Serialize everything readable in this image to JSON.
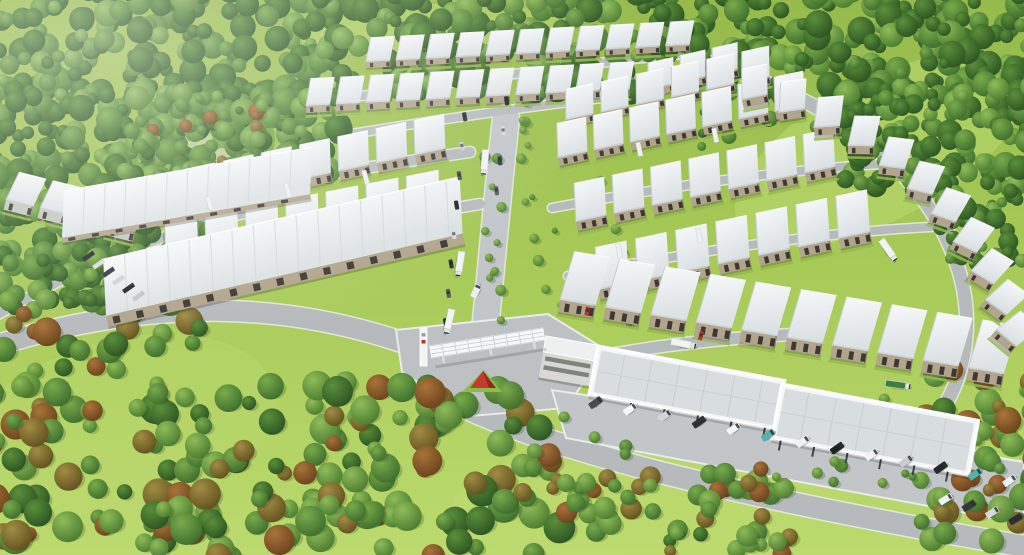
{
  "scene": {
    "width": 1024,
    "height": 555,
    "alt_text": "Aerial 3D rendering of a logistics industrial park with rows of white-roofed warehouses surrounded by forest, an entrance gate with truss gantry, office building and long parking canopy with vans"
  },
  "palette": {
    "grass_top": "#96ba4b",
    "grass_mid": "#a6c957",
    "grass_bottom": "#bcda6e",
    "meadow": "#bedb72",
    "road": "#b6babd",
    "road_light": "#c2c6c9",
    "curb": "#e9ebea",
    "roof_hi": "#f7f9fa",
    "roof_lo": "#dce1e4",
    "fascia": "#ccd3d7",
    "wall_tan": "#b2a48d",
    "wall_dark": "#94886f",
    "wall_gray": "#c6c6c0",
    "door": "#3d3833",
    "canopy_panel": "#d8dde0",
    "canopy_edge": "#f4f6f7",
    "office_wall": "#d8d9d4",
    "office_band": "#70756c",
    "sign_red": "#c23b2c",
    "sign_red_dark": "#8f2a1f",
    "island_green": "#8cbb4e",
    "truck_green": "#3e7c3f",
    "teal": "#52b2a8",
    "tree_greens": [
      [
        "#79ab4b",
        "#3f6e2e"
      ],
      [
        "#5b8f3a",
        "#2c5423"
      ],
      [
        "#8fbc59",
        "#4c7c31"
      ],
      [
        "#a08d45",
        "#63511f"
      ],
      [
        "#a8743b",
        "#6b431c"
      ]
    ]
  },
  "meadows": [
    {
      "cx": 430,
      "cy": 30,
      "rx": 130,
      "ry": 26,
      "rot": -3,
      "o": 0.45
    },
    {
      "cx": 880,
      "cy": 150,
      "rx": 160,
      "ry": 70,
      "rot": -28,
      "o": 0.5
    },
    {
      "cx": 660,
      "cy": 490,
      "rx": 210,
      "ry": 62,
      "rot": -6,
      "o": 0.45
    },
    {
      "cx": 120,
      "cy": 430,
      "rx": 160,
      "ry": 90,
      "rot": -15,
      "o": 0.35
    }
  ],
  "park": {
    "cx": 202,
    "cy": 148,
    "rx": 74,
    "ry": 52,
    "rot": -14,
    "base": "#74a441",
    "plaza": [
      {
        "cx": 198,
        "cy": 142,
        "r": 15
      },
      {
        "cx": 222,
        "cy": 158,
        "r": 10
      }
    ],
    "sails": [
      [
        168,
        120
      ],
      [
        188,
        112
      ],
      [
        208,
        117
      ],
      [
        226,
        125
      ]
    ],
    "gazebo": {
      "x": 203,
      "y": 164,
      "w": 13,
      "h": 8,
      "rot": -12,
      "color": "#4a4a40"
    }
  },
  "forest_regions": [
    {
      "x": -12,
      "y": -10,
      "w": 1048,
      "h": 105,
      "n": 520,
      "rmin": 6,
      "rmax": 14,
      "pal": "forest",
      "seed": 11
    },
    {
      "x": -12,
      "y": 88,
      "w": 352,
      "h": 88,
      "n": 200,
      "rmin": 6,
      "rmax": 14,
      "pal": "forest",
      "seed": 22
    },
    {
      "x": -12,
      "y": 168,
      "w": 250,
      "h": 88,
      "n": 120,
      "rmin": 6,
      "rmax": 14,
      "pal": "forest",
      "seed": 33
    },
    {
      "x": -12,
      "y": 248,
      "w": 130,
      "h": 62,
      "n": 60,
      "rmin": 6,
      "rmax": 13,
      "pal": "forest",
      "seed": 44
    },
    {
      "x": 838,
      "y": 86,
      "w": 198,
      "h": 104,
      "n": 130,
      "rmin": 6,
      "rmax": 13,
      "pal": "forest",
      "seed": 55
    },
    {
      "x": 938,
      "y": 182,
      "w": 98,
      "h": 84,
      "n": 55,
      "rmin": 5,
      "rmax": 12,
      "pal": "forest",
      "seed": 66
    },
    {
      "x": 700,
      "y": 58,
      "w": 250,
      "h": 95,
      "n": 40,
      "rmin": 4,
      "rmax": 8,
      "pal": "conifer",
      "seed": 77
    },
    {
      "x": -12,
      "y": 300,
      "w": 215,
      "h": 248,
      "n": 80,
      "rmin": 7,
      "rmax": 16,
      "pal": "mixed",
      "seed": 88
    },
    {
      "x": 150,
      "y": 378,
      "w": 410,
      "h": 180,
      "n": 130,
      "rmin": 7,
      "rmax": 16,
      "pal": "mixed",
      "seed": 99
    },
    {
      "x": 545,
      "y": 468,
      "w": 245,
      "h": 90,
      "n": 55,
      "rmin": 6,
      "rmax": 12,
      "pal": "mixed",
      "seed": 111
    },
    {
      "x": 918,
      "y": 362,
      "w": 118,
      "h": 180,
      "n": 50,
      "rmin": 6,
      "rmax": 14,
      "pal": "mixed",
      "seed": 122
    },
    {
      "x": 128,
      "y": 96,
      "w": 150,
      "h": 104,
      "n": 45,
      "rmin": 4,
      "rmax": 9,
      "pal": "mixed",
      "seed": 133
    },
    {
      "x": 484,
      "y": 120,
      "w": 18,
      "h": 215,
      "n": 13,
      "rmin": 3,
      "rmax": 6,
      "pal": "lawn",
      "seed": 144
    },
    {
      "x": 520,
      "y": 100,
      "w": 14,
      "h": 110,
      "n": 8,
      "rmin": 3,
      "rmax": 6,
      "pal": "lawn",
      "seed": 155
    },
    {
      "x": 560,
      "y": 395,
      "w": 440,
      "h": 90,
      "n": 18,
      "rmin": 4,
      "rmax": 7,
      "pal": "lawn",
      "seed": 166
    },
    {
      "x": 534,
      "y": 150,
      "w": 110,
      "h": 190,
      "n": 12,
      "rmin": 3,
      "rmax": 6,
      "pal": "lawn",
      "seed": 177
    }
  ],
  "roads": [
    {
      "name": "perimeter-west",
      "d": "M -12,348 C 150,296 292,300 424,350",
      "w": 20,
      "c": "road"
    },
    {
      "name": "south-exit",
      "d": "M 470,410 C 580,460 780,505 1034,548",
      "w": 21,
      "c": "road"
    },
    {
      "name": "entry-avenue",
      "d": "M 484,340 C 492,260 498,190 506,118",
      "w": 26,
      "c": "road_light"
    },
    {
      "name": "cross-1",
      "d": "M 56,218 C 200,196 330,172 470,152",
      "w": 10,
      "c": "road"
    },
    {
      "name": "cross-2",
      "d": "M 96,272 C 240,248 370,222 480,204",
      "w": 10,
      "c": "road"
    },
    {
      "name": "left-front",
      "d": "M -8,318 C 70,272 150,236 250,212",
      "w": 9,
      "c": "road"
    },
    {
      "name": "top-service-1",
      "d": "M 348,98 C 470,80 590,62 704,52",
      "w": 8,
      "c": "road"
    },
    {
      "name": "top-service-2",
      "d": "M 292,144 C 420,122 545,103 660,92",
      "w": 8,
      "c": "road"
    },
    {
      "name": "right-curve",
      "d": "M 686,56 C 845,98 928,180 956,262 C 976,318 968,384 928,428",
      "w": 13,
      "c": "road"
    },
    {
      "name": "right-inner-1",
      "d": "M 552,208 C 690,182 820,166 918,162",
      "w": 8,
      "c": "road"
    },
    {
      "name": "right-inner-2",
      "d": "M 568,276 C 700,250 840,230 952,226",
      "w": 8,
      "c": "road"
    },
    {
      "name": "canopy-access",
      "d": "M 498,380 C 600,352 690,340 800,334",
      "w": 11,
      "c": "road"
    },
    {
      "name": "east-exit",
      "d": "M 928,428 C 950,452 980,462 1022,468",
      "w": 12,
      "c": "road"
    }
  ],
  "plaza": "396,330 548,314 606,350 566,408 470,416 402,372",
  "apron": "552,390 1024,462 1024,524 566,438",
  "clusters": [
    {
      "name": "top-row-1",
      "x": 366,
      "y": 62,
      "a": -3,
      "n": 11,
      "pitch": 30,
      "w": 24,
      "L": 24,
      "wall": 6,
      "doors": 2
    },
    {
      "name": "top-row-2",
      "x": 306,
      "y": 106,
      "a": -3,
      "n": 11,
      "pitch": 30,
      "w": 24,
      "L": 27,
      "wall": 7,
      "doors": 2
    },
    {
      "name": "top-right-row",
      "x": 648,
      "y": 90,
      "a": -13,
      "n": 3,
      "pitch": 33,
      "w": 26,
      "L": 26,
      "wall": 7,
      "doors": 2
    },
    {
      "name": "right-row-0",
      "x": 566,
      "y": 120,
      "a": -12,
      "n": 6,
      "pitch": 36,
      "w": 28,
      "L": 30,
      "wall": 7,
      "doors": 2
    },
    {
      "name": "left-row-a",
      "x": 148,
      "y": 212,
      "a": -12,
      "n": 8,
      "pitch": 39,
      "w": 31,
      "L": 34,
      "wall": 9,
      "doors": 3
    },
    {
      "name": "right-row-1",
      "x": 558,
      "y": 158,
      "a": -12,
      "n": 7,
      "pitch": 37,
      "w": 30,
      "L": 34,
      "wall": 8,
      "doors": 3
    },
    {
      "name": "right-row-2",
      "x": 576,
      "y": 222,
      "a": -12,
      "n": 7,
      "pitch": 39,
      "w": 31,
      "L": 38,
      "wall": 9,
      "doors": 3
    },
    {
      "name": "left-row-b",
      "x": 166,
      "y": 262,
      "a": -11,
      "n": 7,
      "pitch": 41,
      "w": 33,
      "L": 38,
      "wall": 10,
      "doors": 3
    },
    {
      "name": "far-left-row",
      "x": 6,
      "y": 200,
      "a": 14,
      "n": 4,
      "pitch": 35,
      "w": 28,
      "L": 30,
      "wall": 10,
      "doors": 2,
      "wc": "#c6c6c0"
    },
    {
      "name": "right-row-3",
      "x": 598,
      "y": 290,
      "a": -12,
      "n": 7,
      "pitch": 41,
      "w": 32,
      "L": 42,
      "wall": 10,
      "doors": 3
    },
    {
      "name": "bottom-row",
      "x": 560,
      "y": 300,
      "a": 9.5,
      "n": 10,
      "pitch": 46,
      "w": 36,
      "L": 50,
      "wall": 12,
      "doors": 3
    }
  ],
  "blocks": [
    {
      "name": "west-hall-a",
      "x": 62,
      "y": 238,
      "a": -10,
      "len": 252,
      "dep": 46,
      "seam": 21,
      "wall": 5
    },
    {
      "name": "west-hall-b",
      "x": 106,
      "y": 316,
      "a": -13,
      "len": 366,
      "dep": 56,
      "seam": 22,
      "wall": 11
    }
  ],
  "stepped": {
    "w": 26,
    "L": 30,
    "wall": 8,
    "doors": 2,
    "units": [
      [
        742,
        100,
        -12
      ],
      [
        779,
        113,
        -8
      ],
      [
        814,
        128,
        -4
      ],
      [
        848,
        146,
        1
      ],
      [
        879,
        166,
        7
      ],
      [
        907,
        189,
        13
      ],
      [
        931,
        214,
        19
      ],
      [
        953,
        242,
        25
      ],
      [
        971,
        271,
        31
      ],
      [
        985,
        300,
        36
      ],
      [
        996,
        330,
        40
      ]
    ]
  },
  "canopy": {
    "a": 10.5,
    "sections": [
      {
        "x": 598,
        "y": 346,
        "len": 190,
        "dep": 50
      },
      {
        "x": 782,
        "y": 384,
        "len": 200,
        "dep": 56
      }
    ]
  },
  "office": {
    "x": 546,
    "y": 336,
    "a": 10,
    "w": 52,
    "roof_h": 16,
    "body_h": 26
  },
  "entrance": {
    "gantry": {
      "x": 430,
      "y": 346,
      "a": -9,
      "len": 114,
      "dep": 12
    },
    "pylon": {
      "x": 420,
      "y": 328,
      "w": 7,
      "h": 38
    },
    "island": "462,392 502,392 484,370",
    "sign": "470,388 496,388 483,371",
    "sign_side": "483,371 496,388 489,388"
  },
  "vehicles": {
    "vans_row": {
      "x0": 588,
      "y0": 404,
      "x1": 1002,
      "y1": 482,
      "n": 13,
      "a": -35,
      "colors": [
        "#454a4e",
        "#f4f5f6",
        "#d3d6d8",
        "#2b3034",
        "#f4f5f6",
        "#52b2a8",
        "#eef0f1",
        "#1f2327",
        "#f2f3f4",
        "#c9cdd0",
        "#24282c",
        "#52b2a8",
        "#eef0f1"
      ]
    },
    "vans_row2": {
      "x0": 938,
      "y0": 500,
      "x1": 1008,
      "y1": 520,
      "n": 4,
      "a": -32,
      "colors": [
        "#f2f3f4",
        "#34383c",
        "#d6d9db",
        "#2a2e32"
      ]
    },
    "cars_a": {
      "x0": 466,
      "y0": 112,
      "x1": 447,
      "y1": 318,
      "n": 8,
      "a": 80
    },
    "cars_b": {
      "x0": 508,
      "y0": 96,
      "x1": 498,
      "y1": 186,
      "n": 4,
      "a": 82
    },
    "car_colors": [
      "#2c3034",
      "#c9cdd0",
      "#4a5054",
      "#23262a",
      "#d6d9db",
      "#34383c",
      "#585e62",
      "#1f2226"
    ],
    "red_cars": [
      [
        590,
        307,
        100
      ],
      [
        704,
        332,
        104
      ]
    ],
    "trucks": [
      {
        "x": 489,
        "y": 150,
        "a": 95,
        "t": "semi"
      },
      {
        "x": 465,
        "y": 252,
        "a": 99,
        "t": "semi"
      },
      {
        "x": 455,
        "y": 310,
        "a": 103,
        "t": "semi"
      },
      {
        "x": 672,
        "y": 338,
        "a": 12,
        "t": "semi"
      },
      {
        "x": 884,
        "y": 238,
        "a": 55,
        "t": "semi"
      },
      {
        "x": 886,
        "y": 380,
        "a": 8,
        "t": "green"
      },
      {
        "x": 446,
        "y": 350,
        "a": -28,
        "t": "van",
        "c": "#f1f2f3"
      },
      {
        "x": 500,
        "y": 340,
        "a": -28,
        "t": "van",
        "c": "#f6f7f8"
      },
      {
        "x": 470,
        "y": 296,
        "a": -65,
        "t": "van",
        "c": "#eceeef"
      }
    ],
    "dock_trailers": [
      [
        210,
        196,
        75
      ],
      [
        288,
        183,
        75
      ],
      [
        366,
        170,
        75
      ],
      [
        640,
        142,
        78
      ],
      [
        716,
        128,
        78
      ],
      [
        620,
        243,
        80
      ],
      [
        700,
        228,
        80
      ]
    ],
    "trailer_row": {
      "x": 82,
      "y": 258,
      "dx": 10,
      "dy": 8,
      "n": 6,
      "a": -35,
      "colors": [
        "#2b2e32",
        "#d8dbdd",
        "#34373b",
        "#cfd2d4",
        "#25282c",
        "#c3c7c9"
      ]
    }
  }
}
